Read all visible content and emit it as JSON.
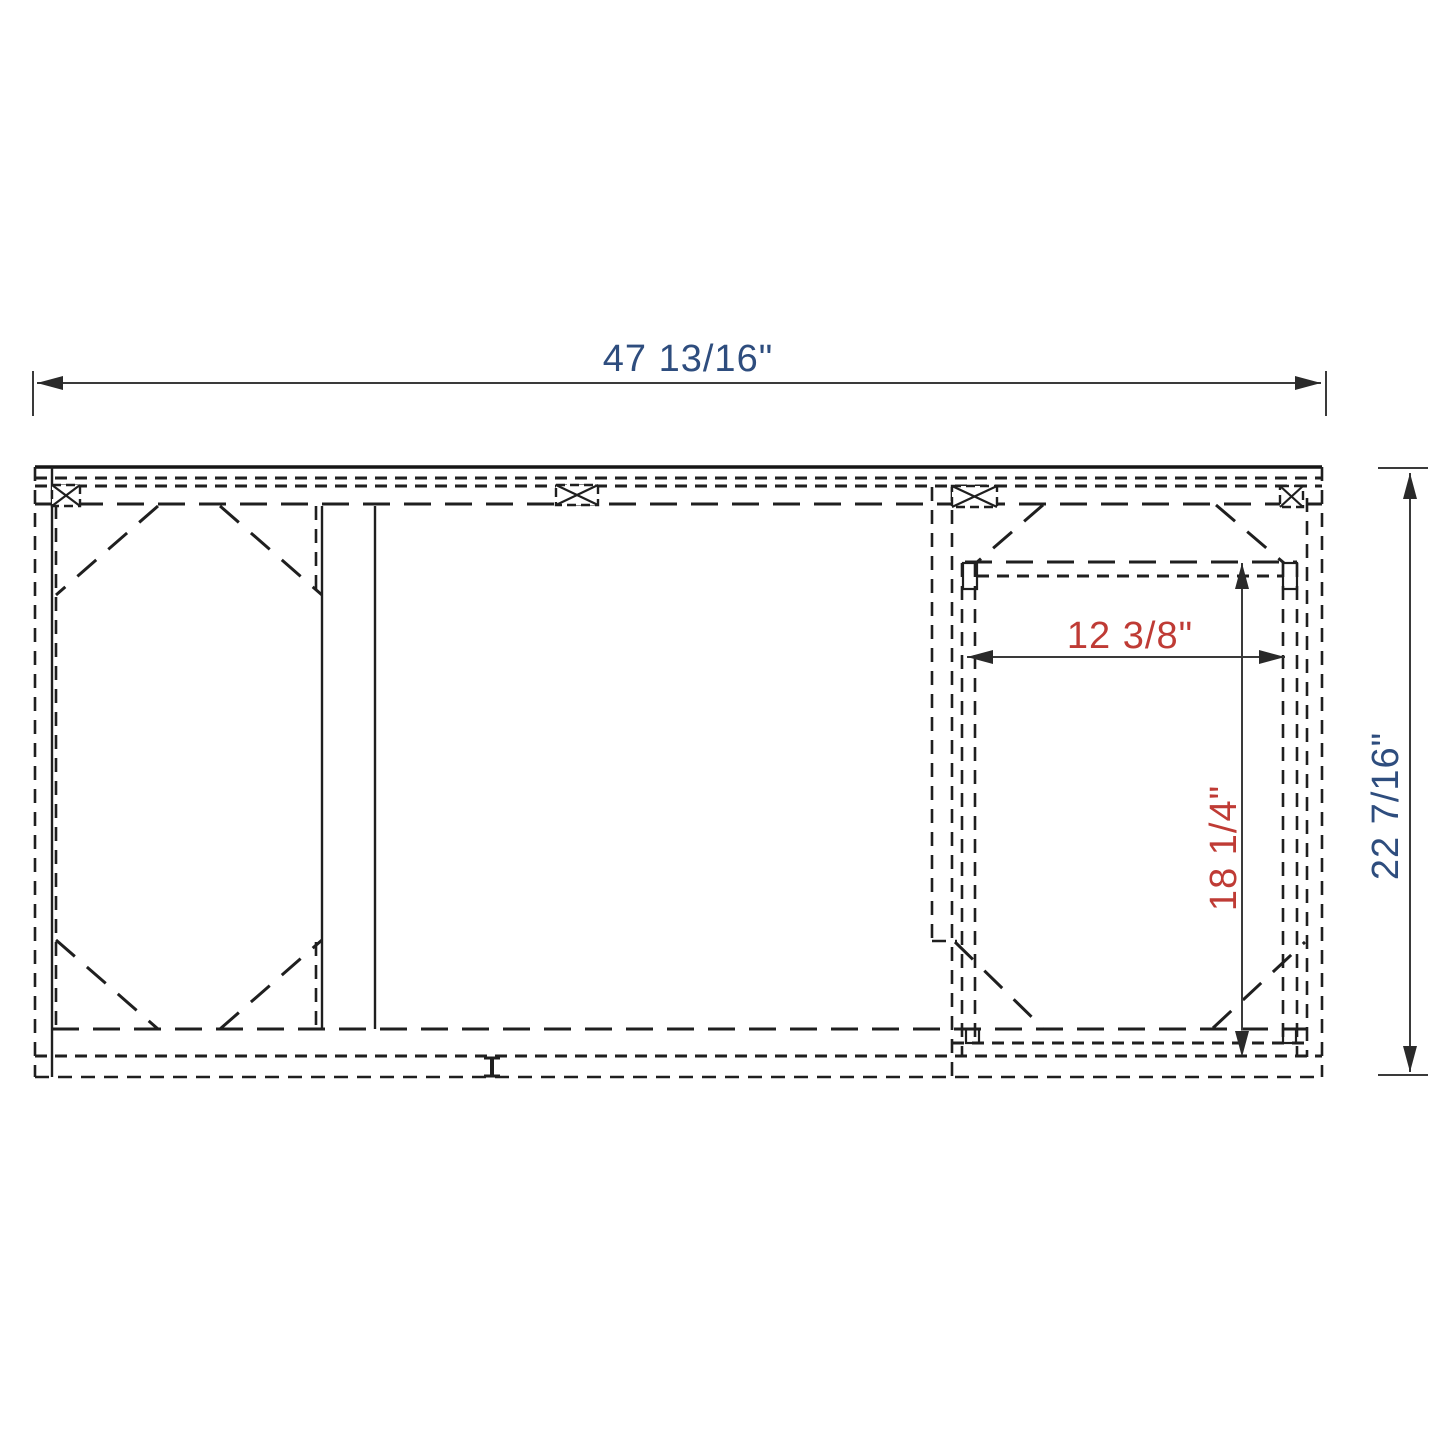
{
  "drawing": {
    "kind": "cabinet-frame-dimension-drawing",
    "dimensions": {
      "overall_width": {
        "text": "47 13/16\"",
        "color": "#2e4d7e",
        "orientation": "horizontal"
      },
      "overall_depth": {
        "text": "22 7/16\"",
        "color": "#2e4d7e",
        "orientation": "vertical"
      },
      "opening_width": {
        "text": "12 3/8\"",
        "color": "#bf3b35",
        "orientation": "horizontal"
      },
      "opening_height": {
        "text": "18 1/4\"",
        "color": "#bf3b35",
        "orientation": "vertical"
      }
    },
    "style": {
      "object_line_color": "#1f1f1f",
      "dimension_line_color": "#3a3a3a",
      "background": "#ffffff"
    }
  }
}
